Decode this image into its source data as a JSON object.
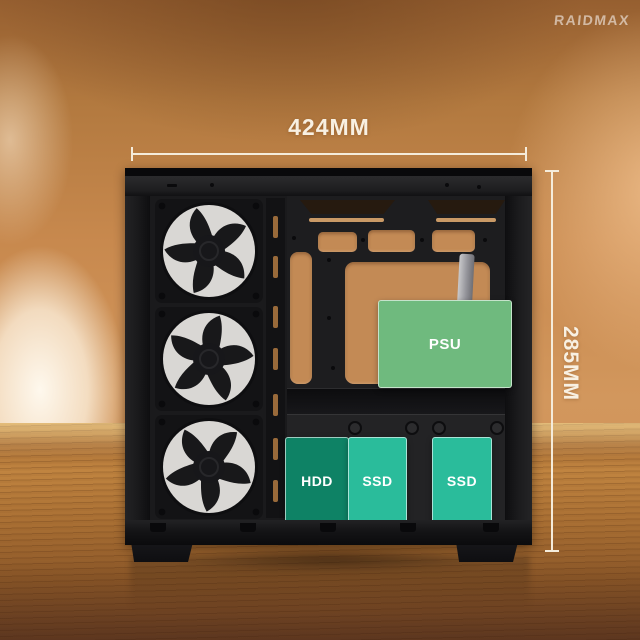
{
  "brand": {
    "logo_text": "RAIDMAX"
  },
  "annotations": {
    "width_dimension": "424MM",
    "height_dimension": "285MM",
    "line_color": "#f5ecdb"
  },
  "components": {
    "psu": {
      "label": "PSU",
      "color": "#6fba7e"
    },
    "hdd": {
      "label": "HDD",
      "color": "#0e8265"
    },
    "ssd_front": {
      "label": "SSD",
      "color": "#2abc9b"
    },
    "ssd_rear": {
      "label": "SSD",
      "color": "#2abc9b"
    }
  },
  "case": {
    "fan_count": "3",
    "body_color": "#19191b"
  }
}
